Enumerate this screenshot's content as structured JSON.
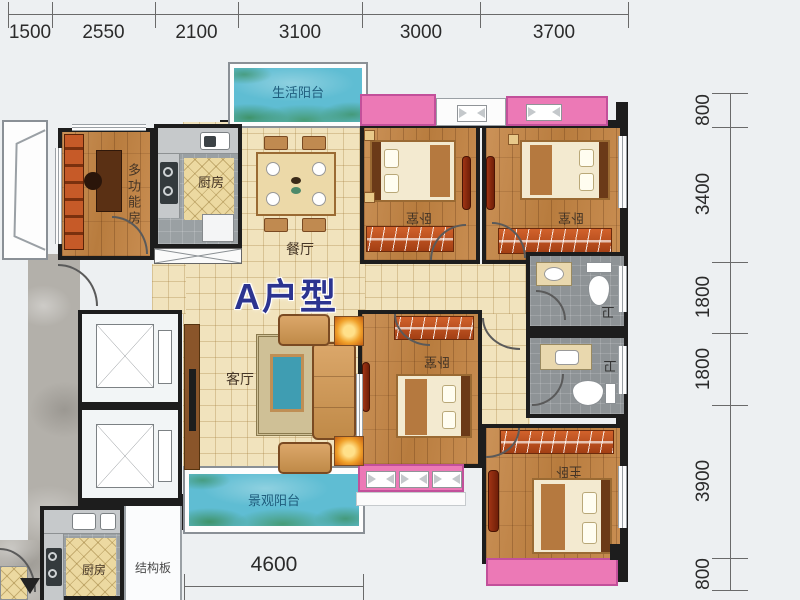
{
  "title": "A户型",
  "dimensions": {
    "top": [
      "1500",
      "2550",
      "2100",
      "3100",
      "3000",
      "3700"
    ],
    "right": [
      "800",
      "3400",
      "1800",
      "1800",
      "3900",
      "800"
    ],
    "bottom": [
      "4600"
    ]
  },
  "rooms": {
    "life_balcony": "生活阳台",
    "multi_function_room": "多功能房",
    "kitchen_main": "厨房",
    "dining": "餐厅",
    "living": "客厅",
    "view_balcony": "景观阳台",
    "kitchen_neighbor": "厨房",
    "slab": "结构板",
    "bedroom_a": "卧室",
    "bedroom_b": "卧室",
    "bedroom_c": "卧室",
    "master": "主卧",
    "bath_top": "卫",
    "bath_bottom": "卫"
  },
  "colors": {
    "title_blue": "#2c3490",
    "bay_window_pink": "#ec79b6",
    "balcony_water": "#5fbdd3",
    "wood_floor": "#c28a4e",
    "tile_floor": "#f1e3bd",
    "balcony_label_blue": "#1f5d7d"
  }
}
